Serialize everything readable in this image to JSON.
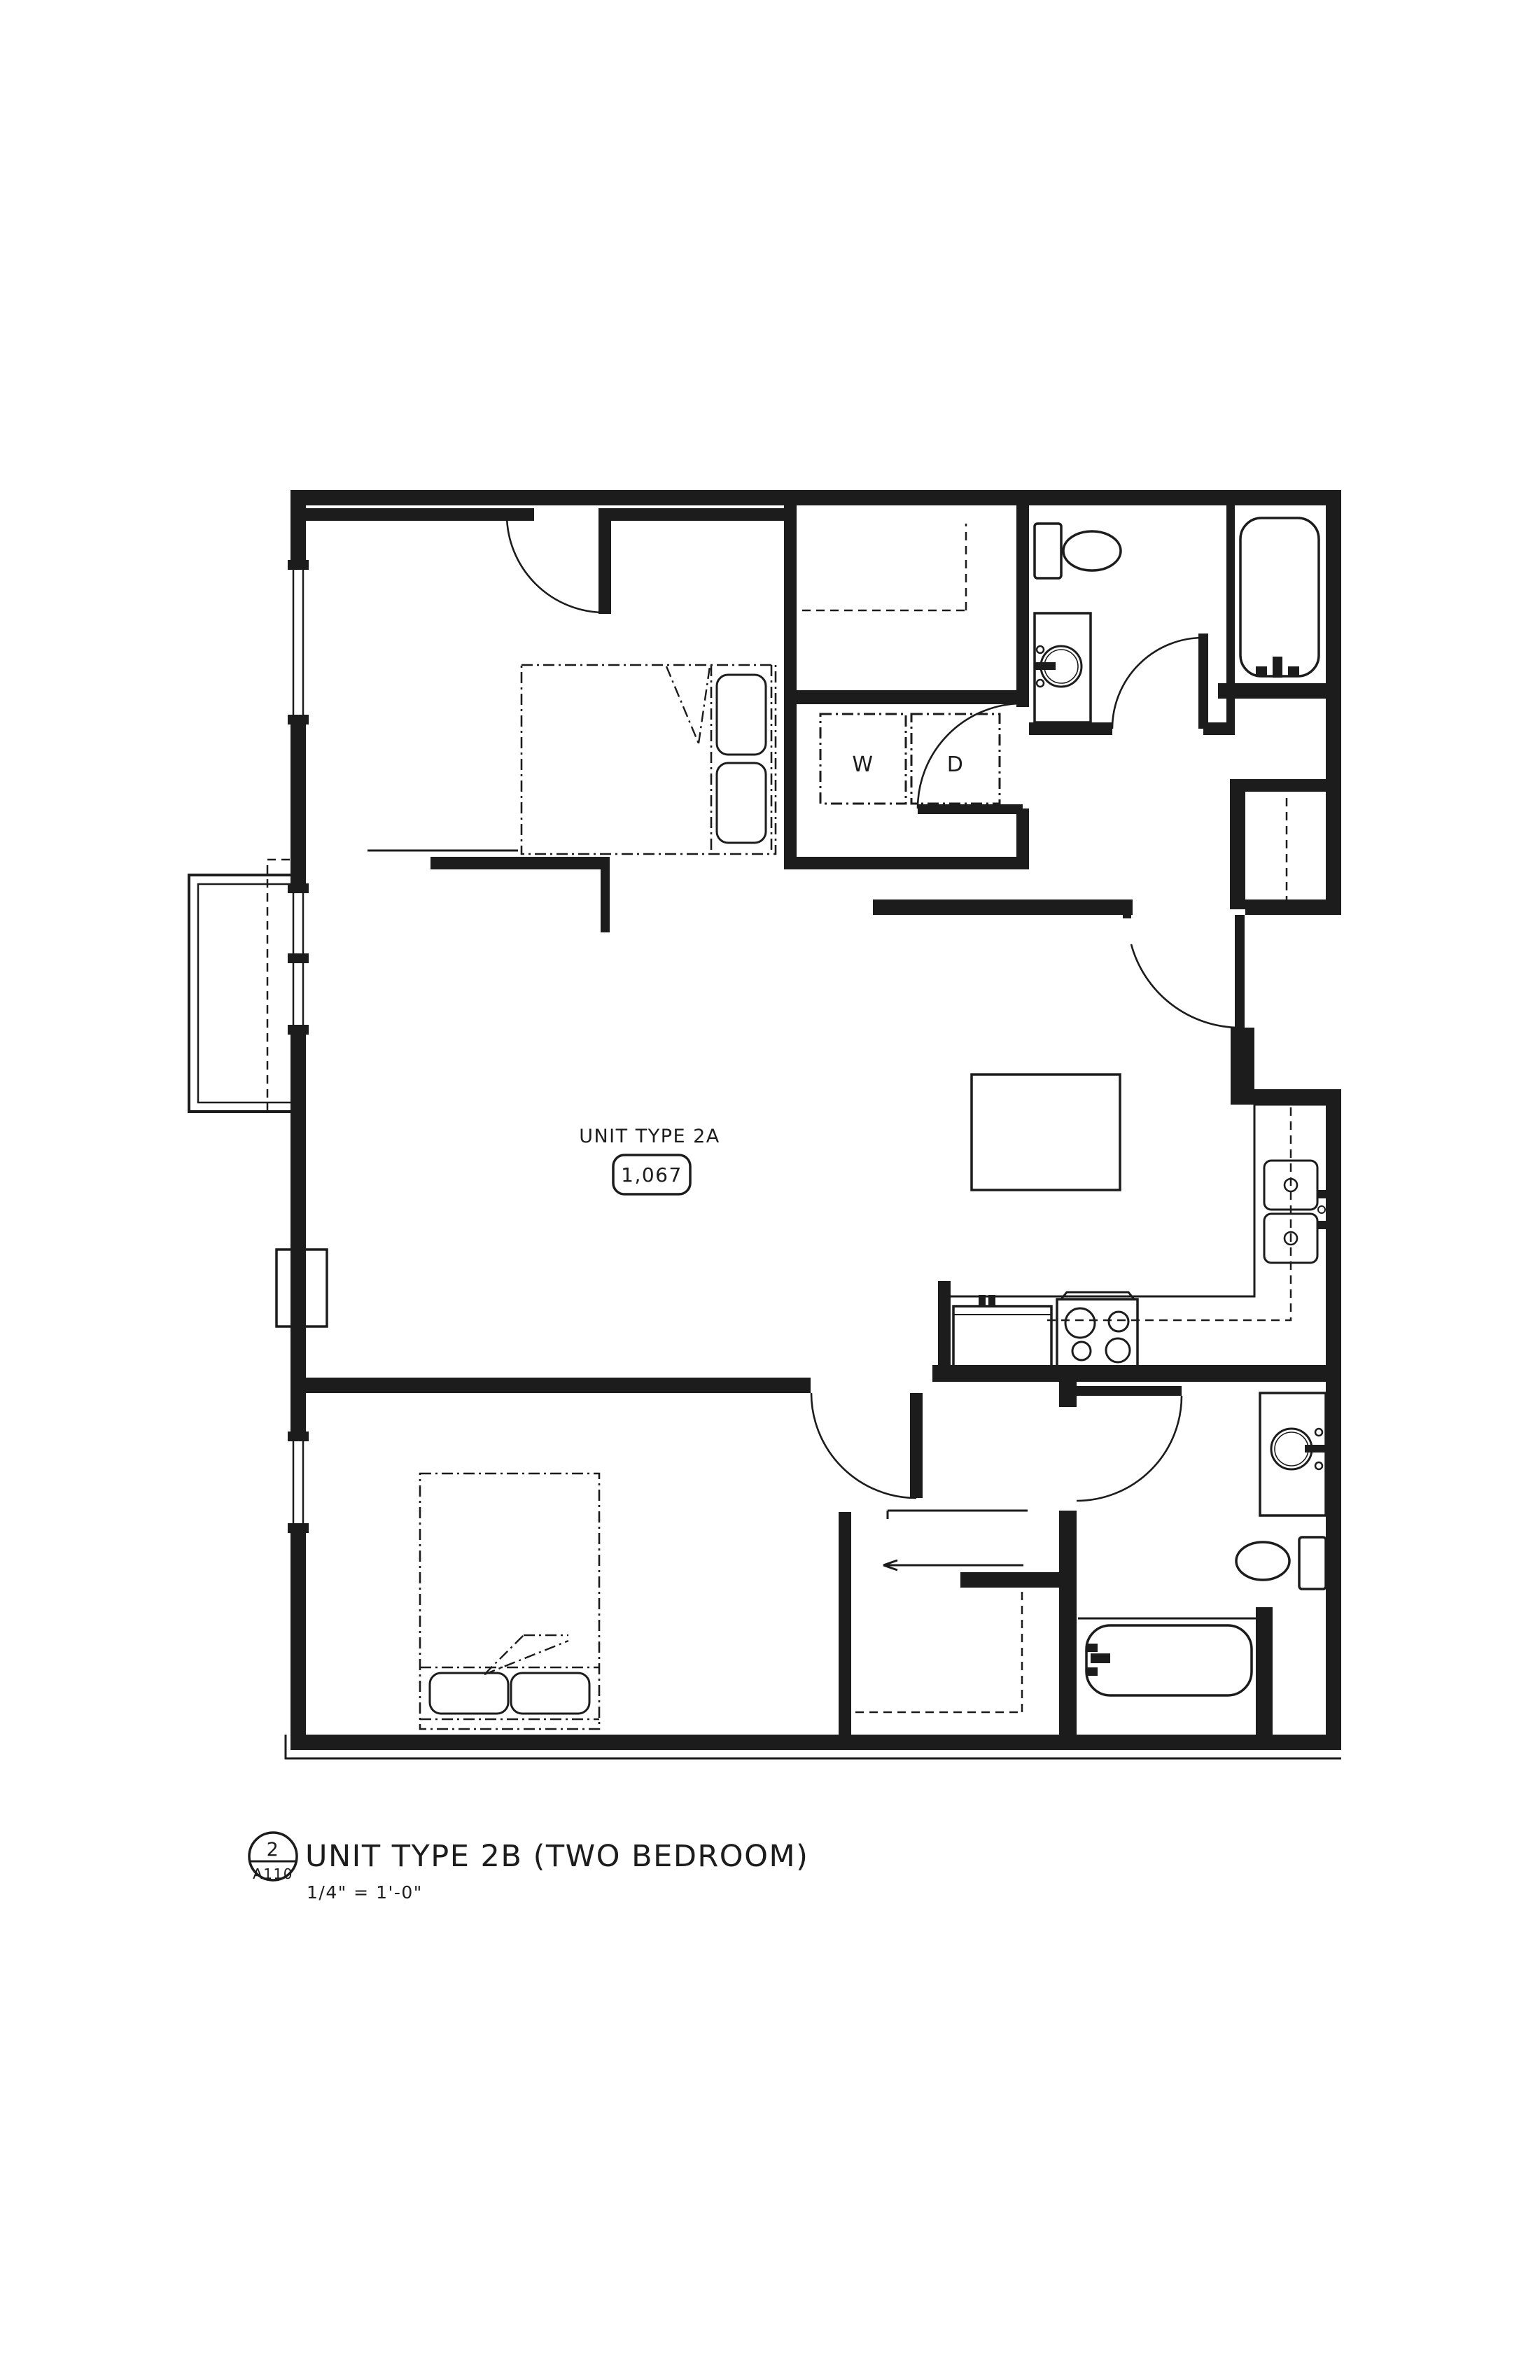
{
  "document": {
    "kind": "architectural-floor-plan",
    "background_color": "#ffffff",
    "line_color": "#1c1c1c"
  },
  "plan": {
    "unit_label": "UNIT TYPE 2A",
    "unit_area": "1,067",
    "laundry": {
      "washer_label": "W",
      "dryer_label": "D"
    },
    "rooms": [
      "bedroom-1",
      "bedroom-2",
      "living-dining",
      "kitchen",
      "bathroom-1",
      "bathroom-2",
      "laundry-closet",
      "walk-in-closet",
      "coat-closet",
      "hall-closet",
      "balcony",
      "entry"
    ],
    "fixtures": [
      "bed",
      "bed",
      "toilet",
      "toilet",
      "vanity-sink",
      "vanity-sink",
      "bathtub",
      "bathtub",
      "washer",
      "dryer",
      "kitchen-island",
      "double-sink",
      "range",
      "refrigerator"
    ]
  },
  "title_block": {
    "detail_number": "2",
    "sheet_number": "A110",
    "title": "UNIT TYPE 2B (TWO BEDROOM)",
    "scale": "1/4\" = 1'-0\""
  }
}
